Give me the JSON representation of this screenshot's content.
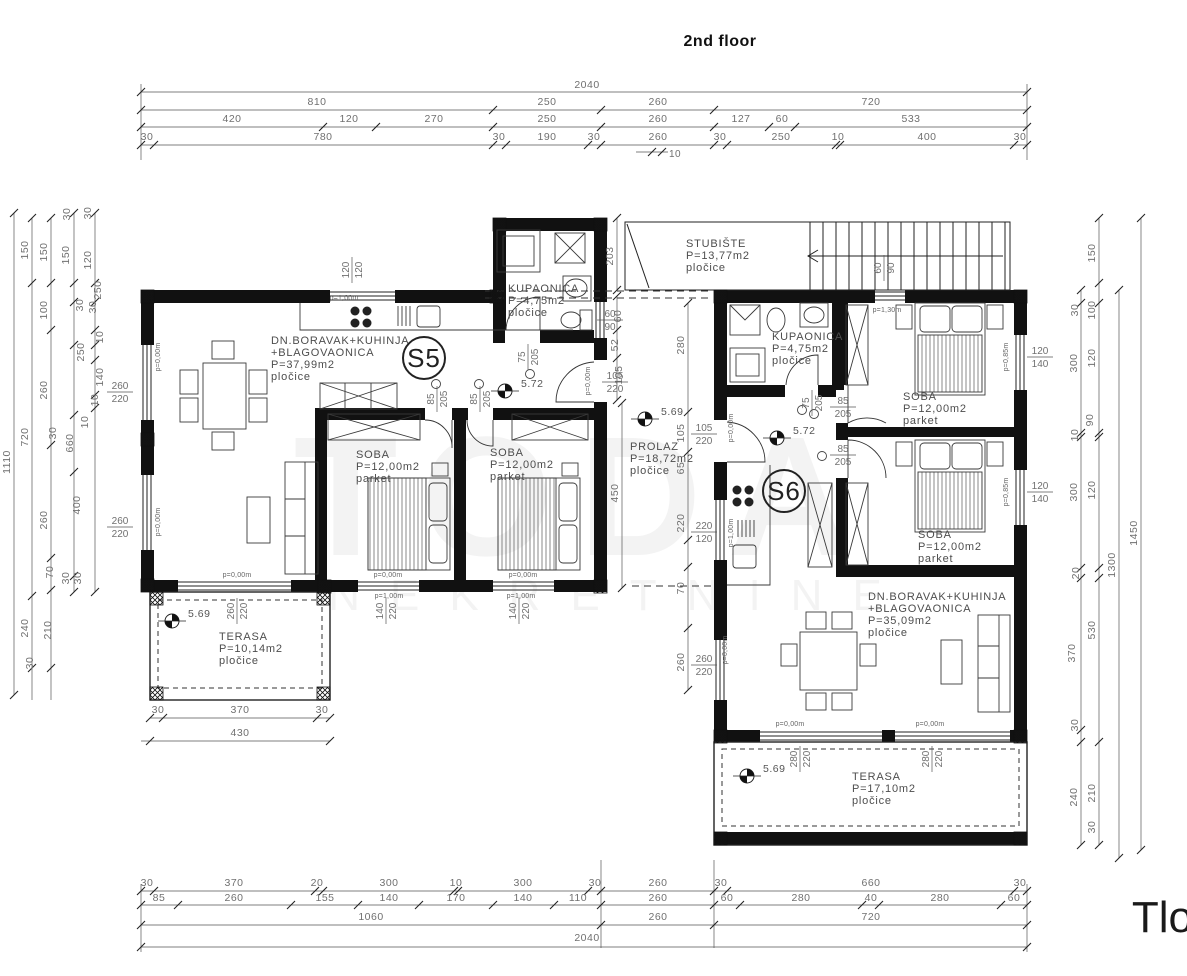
{
  "title": "2nd floor",
  "sheet_corner_text": "Tlo",
  "watermark": {
    "big": "TODA",
    "small": "NEKRETNINE"
  },
  "colors": {
    "wall": "#111111",
    "line": "#2a2a2a",
    "dim_text": "#707070",
    "room_text": "#4d4d4d"
  },
  "units": [
    {
      "id": "S5",
      "cx": 424,
      "cy": 358
    },
    {
      "id": "S6",
      "cx": 784,
      "cy": 491
    }
  ],
  "rooms": [
    {
      "lines": [
        "DN.BORAVAK+KUHINJA",
        "+BLAGOVAONICA",
        "P=37,99m2",
        "pločice"
      ],
      "x": 271,
      "y": 344
    },
    {
      "lines": [
        "KUPAONICA",
        "P=4,75m2",
        "pločice"
      ],
      "x": 508,
      "y": 292
    },
    {
      "lines": [
        "STUBIŠTE",
        "P=13,77m2",
        "pločice"
      ],
      "x": 686,
      "y": 247
    },
    {
      "lines": [
        "SOBA",
        "P=12,00m2",
        "parket"
      ],
      "x": 356,
      "y": 458
    },
    {
      "lines": [
        "SOBA",
        "P=12,00m2",
        "parket"
      ],
      "x": 490,
      "y": 456
    },
    {
      "lines": [
        "PROLAZ",
        "P=18,72m2",
        "pločice"
      ],
      "x": 630,
      "y": 450
    },
    {
      "lines": [
        "KUPAONICA",
        "P=4,75m2",
        "pločice"
      ],
      "x": 772,
      "y": 340
    },
    {
      "lines": [
        "SOBA",
        "P=12,00m2",
        "parket"
      ],
      "x": 903,
      "y": 400
    },
    {
      "lines": [
        "SOBA",
        "P=12,00m2",
        "parket"
      ],
      "x": 918,
      "y": 538
    },
    {
      "lines": [
        "DN.BORAVAK+KUHINJA",
        "+BLAGOVAONICA",
        "P=35,09m2",
        "pločice"
      ],
      "x": 868,
      "y": 600
    },
    {
      "lines": [
        "TERASA",
        "P=10,14m2",
        "pločice"
      ],
      "x": 219,
      "y": 640
    },
    {
      "lines": [
        "TERASA",
        "P=17,10m2",
        "pločice"
      ],
      "x": 852,
      "y": 780
    }
  ],
  "levels": [
    {
      "t": "5.72",
      "x": 505,
      "y": 391
    },
    {
      "t": "5.69",
      "x": 645,
      "y": 419
    },
    {
      "t": "5.72",
      "x": 777,
      "y": 438
    },
    {
      "t": "5.69",
      "x": 172,
      "y": 621
    },
    {
      "t": "5.69",
      "x": 747,
      "y": 776
    }
  ],
  "window_sizes": [
    {
      "a": "260",
      "b": "220",
      "x": 120,
      "y": 392,
      "rot": false
    },
    {
      "a": "260",
      "b": "220",
      "x": 120,
      "y": 527,
      "rot": false
    },
    {
      "a": "120",
      "b": "120",
      "x": 352,
      "y": 270,
      "rot": true
    },
    {
      "a": "60",
      "b": "90",
      "x": 610,
      "y": 320,
      "rot": false
    },
    {
      "a": "105",
      "b": "220",
      "x": 615,
      "y": 382,
      "rot": false
    },
    {
      "a": "260",
      "b": "220",
      "x": 237,
      "y": 611,
      "rot": true
    },
    {
      "a": "140",
      "b": "220",
      "x": 386,
      "y": 611,
      "rot": true
    },
    {
      "a": "140",
      "b": "220",
      "x": 519,
      "y": 611,
      "rot": true
    },
    {
      "a": "60",
      "b": "90",
      "x": 884,
      "y": 268,
      "rot": true
    },
    {
      "a": "105",
      "b": "220",
      "x": 704,
      "y": 434,
      "rot": false
    },
    {
      "a": "220",
      "b": "120",
      "x": 704,
      "y": 532,
      "rot": false
    },
    {
      "a": "260",
      "b": "220",
      "x": 704,
      "y": 665,
      "rot": false
    },
    {
      "a": "120",
      "b": "140",
      "x": 1040,
      "y": 357,
      "rot": false
    },
    {
      "a": "120",
      "b": "140",
      "x": 1040,
      "y": 492,
      "rot": false
    },
    {
      "a": "280",
      "b": "220",
      "x": 800,
      "y": 759,
      "rot": true
    },
    {
      "a": "280",
      "b": "220",
      "x": 932,
      "y": 759,
      "rot": true
    }
  ],
  "door_sizes": [
    {
      "a": "75",
      "b": "205",
      "x": 528,
      "y": 357,
      "rot": true
    },
    {
      "a": "85",
      "b": "205",
      "x": 437,
      "y": 399,
      "rot": true
    },
    {
      "a": "85",
      "b": "205",
      "x": 480,
      "y": 399,
      "rot": true
    },
    {
      "a": "75",
      "b": "205",
      "x": 812,
      "y": 403,
      "rot": true
    },
    {
      "a": "85",
      "b": "205",
      "x": 843,
      "y": 407,
      "rot": false
    },
    {
      "a": "85",
      "b": "205",
      "x": 843,
      "y": 455,
      "rot": false
    }
  ],
  "parapet_notes": [
    {
      "t": "p=0,00m",
      "x": 160,
      "y": 357,
      "rot": true
    },
    {
      "t": "p=0,00m",
      "x": 160,
      "y": 522,
      "rot": true
    },
    {
      "t": "p=1,00m",
      "x": 344,
      "y": 300,
      "rot": false
    },
    {
      "t": "p=0,00m",
      "x": 237,
      "y": 577,
      "rot": false
    },
    {
      "t": "p=0,00m",
      "x": 388,
      "y": 577,
      "rot": false
    },
    {
      "t": "p=0,00m",
      "x": 523,
      "y": 577,
      "rot": false
    },
    {
      "t": "p=1,00m",
      "x": 389,
      "y": 598,
      "rot": false
    },
    {
      "t": "p=1,00m",
      "x": 521,
      "y": 598,
      "rot": false
    },
    {
      "t": "p=0,00m",
      "x": 590,
      "y": 381,
      "rot": true
    },
    {
      "t": "p=1,30m",
      "x": 887,
      "y": 312,
      "rot": false
    },
    {
      "t": "p=0,00m",
      "x": 733,
      "y": 428,
      "rot": true
    },
    {
      "t": "p=1,00m",
      "x": 733,
      "y": 533,
      "rot": true
    },
    {
      "t": "p=0,00m",
      "x": 727,
      "y": 650,
      "rot": true
    },
    {
      "t": "p=0,85m",
      "x": 1008,
      "y": 357,
      "rot": true
    },
    {
      "t": "p=0,85m",
      "x": 1008,
      "y": 492,
      "rot": true
    },
    {
      "t": "p=0,00m",
      "x": 790,
      "y": 726,
      "rot": false
    },
    {
      "t": "p=0,00m",
      "x": 930,
      "y": 726,
      "rot": false
    }
  ],
  "dimensions": {
    "top_rows": [
      {
        "y": 92,
        "ly": 88,
        "ticks": [
          141,
          1027
        ],
        "labels": [
          {
            "t": "2040",
            "x": 587
          }
        ]
      },
      {
        "y": 110,
        "ly": 105,
        "ticks": [
          141,
          493,
          601,
          714,
          1027
        ],
        "labels": [
          {
            "t": "810",
            "x": 317
          },
          {
            "t": "250",
            "x": 547
          },
          {
            "t": "260",
            "x": 658
          },
          {
            "t": "720",
            "x": 871
          }
        ]
      },
      {
        "y": 127,
        "ly": 122,
        "ticks": [
          141,
          323,
          376,
          493,
          601,
          714,
          769,
          795,
          1027
        ],
        "labels": [
          {
            "t": "420",
            "x": 232
          },
          {
            "t": "120",
            "x": 349
          },
          {
            "t": "270",
            "x": 434
          },
          {
            "t": "250",
            "x": 547
          },
          {
            "t": "260",
            "x": 658
          },
          {
            "t": "127",
            "x": 741
          },
          {
            "t": "60",
            "x": 782
          },
          {
            "t": "533",
            "x": 911
          }
        ]
      },
      {
        "y": 145,
        "ly": 140,
        "ticks": [
          141,
          154,
          493,
          506,
          588,
          601,
          714,
          727,
          836,
          840,
          1014,
          1027
        ],
        "labels": [
          {
            "t": "30",
            "x": 147
          },
          {
            "t": "780",
            "x": 323
          },
          {
            "t": "30",
            "x": 499
          },
          {
            "t": "190",
            "x": 547
          },
          {
            "t": "30",
            "x": 594
          },
          {
            "t": "260",
            "x": 658
          },
          {
            "t": "30",
            "x": 720
          },
          {
            "t": "250",
            "x": 781
          },
          {
            "t": "10",
            "x": 838
          },
          {
            "t": "400",
            "x": 927
          },
          {
            "t": "30",
            "x": 1020
          }
        ]
      }
    ],
    "top_sub": {
      "y": 152,
      "x1": 636,
      "x2": 668,
      "ticks": [
        652,
        662
      ],
      "label": {
        "t": "10",
        "x": 675,
        "ly": 157
      }
    },
    "bottom_rows": [
      {
        "y": 891,
        "ly": 886,
        "ticks": [
          141,
          154,
          315,
          323,
          454,
          458,
          588,
          601,
          714,
          727,
          1014,
          1027
        ],
        "labels": [
          {
            "t": "30",
            "x": 147
          },
          {
            "t": "370",
            "x": 234
          },
          {
            "t": "20",
            "x": 317
          },
          {
            "t": "300",
            "x": 389
          },
          {
            "t": "10",
            "x": 456
          },
          {
            "t": "300",
            "x": 523
          },
          {
            "t": "30",
            "x": 595
          },
          {
            "t": "260",
            "x": 658
          },
          {
            "t": "30",
            "x": 721
          },
          {
            "t": "660",
            "x": 871
          },
          {
            "t": "30",
            "x": 1020
          }
        ]
      },
      {
        "y": 905,
        "ly": 901,
        "ticks": [
          141,
          178,
          291,
          358,
          419,
          493,
          554,
          601,
          714,
          740,
          862,
          879,
          1001,
          1027
        ],
        "labels": [
          {
            "t": "85",
            "x": 159
          },
          {
            "t": "260",
            "x": 234
          },
          {
            "t": "155",
            "x": 325
          },
          {
            "t": "140",
            "x": 389
          },
          {
            "t": "170",
            "x": 456
          },
          {
            "t": "140",
            "x": 523
          },
          {
            "t": "110",
            "x": 578
          },
          {
            "t": "260",
            "x": 658
          },
          {
            "t": "60",
            "x": 727
          },
          {
            "t": "280",
            "x": 801
          },
          {
            "t": "40",
            "x": 871
          },
          {
            "t": "280",
            "x": 940
          },
          {
            "t": "60",
            "x": 1014
          }
        ]
      },
      {
        "y": 925,
        "ly": 920,
        "ticks": [
          141,
          601,
          714,
          1027
        ],
        "labels": [
          {
            "t": "1060",
            "x": 371
          },
          {
            "t": "260",
            "x": 658
          },
          {
            "t": "720",
            "x": 871
          }
        ]
      },
      {
        "y": 947,
        "ly": 941,
        "ticks": [
          141,
          1027
        ],
        "labels": [
          {
            "t": "2040",
            "x": 587
          }
        ]
      }
    ],
    "terrace_rows": [
      {
        "y": 718,
        "x1": 150,
        "x2": 330,
        "ly": 713,
        "ticks": [
          150,
          163,
          317,
          330
        ],
        "labels": [
          {
            "t": "30",
            "x": 158
          },
          {
            "t": "370",
            "x": 240
          },
          {
            "t": "30",
            "x": 322
          }
        ]
      },
      {
        "y": 741,
        "x1": 141,
        "x2": 330,
        "ly": 736,
        "ticks": [
          150,
          330
        ],
        "labels": [
          {
            "t": "430",
            "x": 240
          }
        ]
      }
    ],
    "left_lines": [
      {
        "x": 14,
        "y1": 213,
        "y2": 695,
        "ticks": [
          213,
          695
        ]
      },
      {
        "x": 32,
        "y1": 218,
        "y2": 700,
        "ticks": [
          218,
          283,
          596,
          668
        ]
      },
      {
        "x": 51,
        "y1": 218,
        "y2": 700,
        "ticks": [
          218,
          283,
          330,
          445,
          558,
          590,
          668
        ]
      },
      {
        "x": 74,
        "y1": 213,
        "y2": 592,
        "ticks": [
          213,
          283,
          302,
          345,
          415,
          472,
          576,
          592
        ]
      },
      {
        "x": 95,
        "y1": 213,
        "y2": 592,
        "ticks": [
          213,
          283,
          302,
          330,
          345,
          360,
          395,
          408,
          592
        ]
      }
    ],
    "left_labels": [
      {
        "t": "1110",
        "x": 10,
        "y": 462
      },
      {
        "t": "150",
        "x": 28,
        "y": 250
      },
      {
        "t": "720",
        "x": 28,
        "y": 437
      },
      {
        "t": "240",
        "x": 28,
        "y": 628
      },
      {
        "t": "30",
        "x": 33,
        "y": 663
      },
      {
        "t": "150",
        "x": 47,
        "y": 252
      },
      {
        "t": "100",
        "x": 47,
        "y": 310
      },
      {
        "t": "260",
        "x": 47,
        "y": 390
      },
      {
        "t": "30",
        "x": 56,
        "y": 433
      },
      {
        "t": "260",
        "x": 47,
        "y": 520
      },
      {
        "t": "70",
        "x": 53,
        "y": 572
      },
      {
        "t": "210",
        "x": 51,
        "y": 630
      },
      {
        "t": "30",
        "x": 70,
        "y": 214
      },
      {
        "t": "150",
        "x": 69,
        "y": 255
      },
      {
        "t": "30",
        "x": 83,
        "y": 305
      },
      {
        "t": "250",
        "x": 84,
        "y": 352
      },
      {
        "t": "10",
        "x": 88,
        "y": 422
      },
      {
        "t": "660",
        "x": 73,
        "y": 443
      },
      {
        "t": "400",
        "x": 80,
        "y": 505
      },
      {
        "t": "30",
        "x": 69,
        "y": 578
      },
      {
        "t": "30",
        "x": 91,
        "y": 213
      },
      {
        "t": "120",
        "x": 91,
        "y": 260
      },
      {
        "t": "250",
        "x": 101,
        "y": 290
      },
      {
        "t": "30",
        "x": 96,
        "y": 307
      },
      {
        "t": "10",
        "x": 103,
        "y": 337
      },
      {
        "t": "140",
        "x": 103,
        "y": 377
      },
      {
        "t": "10",
        "x": 98,
        "y": 400
      },
      {
        "t": "30",
        "x": 81,
        "y": 578
      }
    ],
    "right_lines": [
      {
        "x": 1081,
        "y1": 290,
        "y2": 845,
        "ticks": [
          290,
          303,
          433,
          437,
          568,
          578,
          730,
          742,
          845
        ]
      },
      {
        "x": 1099,
        "y1": 218,
        "y2": 845,
        "ticks": [
          218,
          283,
          303,
          433,
          437,
          568,
          578,
          742,
          845
        ]
      },
      {
        "x": 1119,
        "y1": 290,
        "y2": 858,
        "ticks": [
          290,
          858
        ]
      },
      {
        "x": 1141,
        "y1": 218,
        "y2": 850,
        "ticks": [
          218,
          850
        ]
      }
    ],
    "right_labels": [
      {
        "t": "150",
        "x": 1095,
        "y": 253
      },
      {
        "t": "30",
        "x": 1078,
        "y": 310
      },
      {
        "t": "100",
        "x": 1095,
        "y": 310
      },
      {
        "t": "300",
        "x": 1077,
        "y": 363
      },
      {
        "t": "120",
        "x": 1095,
        "y": 358
      },
      {
        "t": "10",
        "x": 1078,
        "y": 435
      },
      {
        "t": "90",
        "x": 1093,
        "y": 420
      },
      {
        "t": "300",
        "x": 1077,
        "y": 492
      },
      {
        "t": "120",
        "x": 1095,
        "y": 490
      },
      {
        "t": "20",
        "x": 1079,
        "y": 573
      },
      {
        "t": "370",
        "x": 1075,
        "y": 653
      },
      {
        "t": "530",
        "x": 1095,
        "y": 630
      },
      {
        "t": "30",
        "x": 1078,
        "y": 725
      },
      {
        "t": "240",
        "x": 1077,
        "y": 797
      },
      {
        "t": "210",
        "x": 1095,
        "y": 793
      },
      {
        "t": "30",
        "x": 1095,
        "y": 827
      },
      {
        "t": "1300",
        "x": 1115,
        "y": 565
      },
      {
        "t": "1450",
        "x": 1137,
        "y": 533
      }
    ],
    "interior_lines": [
      {
        "x": 617,
        "y1": 218,
        "y2": 290,
        "ticks": [
          218,
          290
        ]
      },
      {
        "x": 617,
        "y1": 296,
        "y2": 400,
        "ticks": [
          296,
          330,
          358,
          400
        ]
      },
      {
        "x": 688,
        "y1": 303,
        "y2": 690,
        "ticks": [
          303,
          412,
          452,
          540,
          567,
          628,
          690
        ]
      },
      {
        "x": 622,
        "y1": 403,
        "y2": 588,
        "ticks": [
          403,
          588
        ]
      }
    ],
    "interior_labels": [
      {
        "t": "203",
        "x": 613,
        "y": 256
      },
      {
        "t": "60",
        "x": 621,
        "y": 316
      },
      {
        "t": "52",
        "x": 618,
        "y": 345
      },
      {
        "t": "105",
        "x": 622,
        "y": 375
      },
      {
        "t": "450",
        "x": 618,
        "y": 493
      },
      {
        "t": "280",
        "x": 684,
        "y": 345
      },
      {
        "t": "105",
        "x": 684,
        "y": 433
      },
      {
        "t": "65",
        "x": 684,
        "y": 468
      },
      {
        "t": "220",
        "x": 684,
        "y": 523
      },
      {
        "t": "70",
        "x": 684,
        "y": 588
      },
      {
        "t": "260",
        "x": 684,
        "y": 662
      }
    ]
  }
}
